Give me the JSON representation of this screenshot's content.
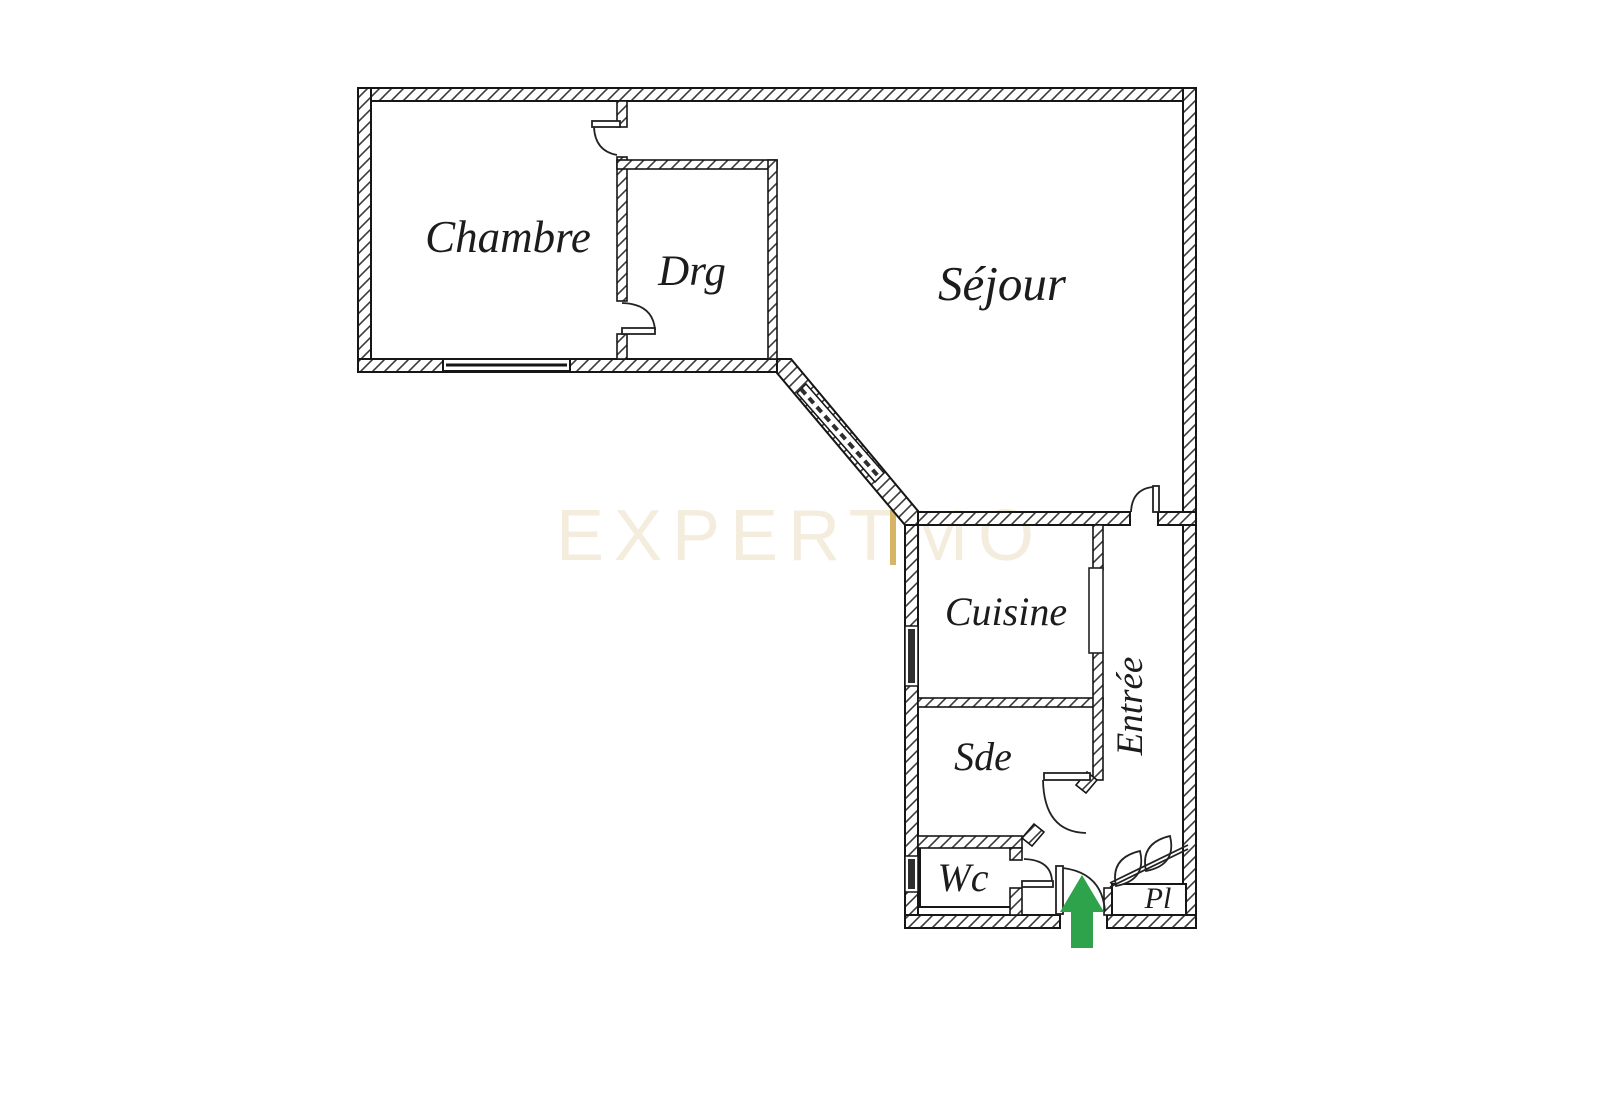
{
  "plan": {
    "background_color": "#ffffff",
    "wall_line_color": "#161616",
    "rooms": {
      "chambre": {
        "label": "Chambre"
      },
      "drg": {
        "label": "Drg"
      },
      "sejour": {
        "label": "Séjour"
      },
      "cuisine": {
        "label": "Cuisine"
      },
      "entree": {
        "label": "Entrée"
      },
      "sde": {
        "label": "Sde"
      },
      "wc": {
        "label": "Wc"
      },
      "pl": {
        "label": "Pl"
      }
    },
    "watermark": {
      "text_left": "EXPERT",
      "text_right": "MO",
      "text_color": "#f4eddd",
      "accent_bar_color": "#d8b466"
    },
    "entrance_arrow": {
      "color": "#2fa24c"
    }
  }
}
